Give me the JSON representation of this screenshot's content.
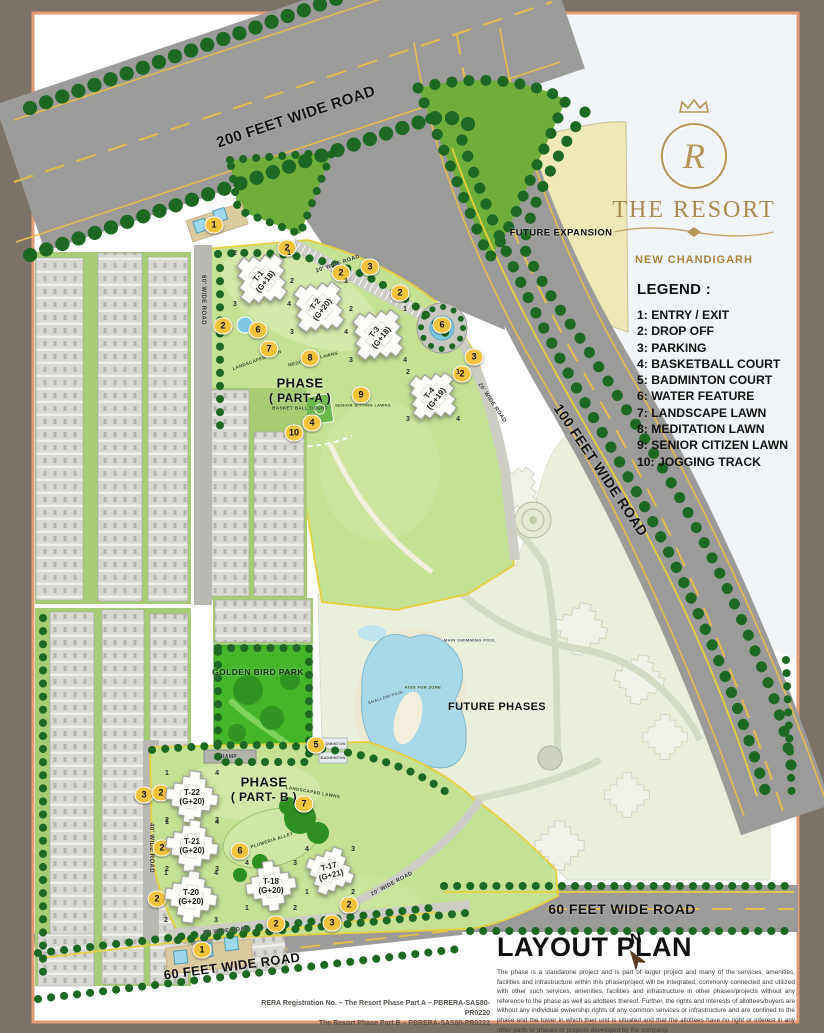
{
  "brand": {
    "monogram": "R",
    "name": "THE RESORT",
    "city": "NEW CHANDIGARH"
  },
  "legend": {
    "title": "LEGEND :",
    "items": [
      "1: ENTRY / EXIT",
      "2: DROP OFF",
      "3: PARKING",
      "4: BASKETBALL COURT",
      "5: BADMINTON COURT",
      "6: WATER FEATURE",
      "7: LANDSCAPE LAWN",
      "8: MEDITATION LAWN",
      "9: SENIOR CITIZEN LAWN",
      "10: JOGGING TRACK"
    ]
  },
  "layout_plan": {
    "title": "LAYOUT PLAN",
    "north_label": "N",
    "disclaimer": "The phase is a standalone project and is part of larger project and many of the services, amenities, facilities and infrastructure within this phase/project will be integrated, commonly connected and utilized with other such services, amenities, facilities and infrastructure in other phases/projects without any reference to the phase as well as allottees thereof. Further, the rights and interests of allottees/buyers are without any individual ownership rights of any common services or infrastructure and are confined to the phase and the tower in which their unit is situated and that the allottees have no right or interest in any other parts or phases or projects developed by the company.",
    "rera_line1": "RERA Registration No. – The Resort Phase Part A – PBRERA-SAS80-PR0220",
    "rera_line2": "The Resort Phase Part B – PBRERA-SAS80-PR0222"
  },
  "map_labels": [
    {
      "text": "200 FEET WIDE ROAD",
      "x": 296,
      "y": 117,
      "rot": -18.5,
      "fs": 15
    },
    {
      "text": "100 FEET WIDE ROAD",
      "x": 601,
      "y": 470,
      "rot": 56,
      "fs": 14
    },
    {
      "text": "60 FEET WIDE ROAD",
      "x": 622,
      "y": 909,
      "rot": 0,
      "fs": 14
    },
    {
      "text": "60 FEET WIDE ROAD",
      "x": 232,
      "y": 966,
      "rot": -7.5,
      "fs": 13
    },
    {
      "text": "FUTURE EXPANSION",
      "x": 561,
      "y": 233,
      "fs": 9.5
    },
    {
      "text": "PHASE",
      "x": 300,
      "y": 383,
      "fs": 13
    },
    {
      "text": "( PART-A )",
      "x": 300,
      "y": 398,
      "fs": 12
    },
    {
      "text": "PHASE",
      "x": 264,
      "y": 782,
      "fs": 13
    },
    {
      "text": "( PART- B )",
      "x": 264,
      "y": 797,
      "fs": 12
    },
    {
      "text": "GOLDEN BIRD PARK",
      "x": 258,
      "y": 672,
      "fs": 8.5,
      "color": "#12300a"
    },
    {
      "text": "FUTURE PHASES",
      "x": 497,
      "y": 707,
      "fs": 11
    },
    {
      "text": "20' WIDE ROAD",
      "x": 338,
      "y": 264,
      "rot": -19,
      "fs": 5.5,
      "color": "#333"
    },
    {
      "text": "20' WIDE ROAD",
      "x": 492,
      "y": 403,
      "rot": 56,
      "fs": 5.5,
      "color": "#333"
    },
    {
      "text": "20' WIDE ROAD",
      "x": 226,
      "y": 931,
      "rot": -6,
      "fs": 5.5,
      "color": "#333"
    },
    {
      "text": "20' WIDE ROAD",
      "x": 392,
      "y": 884,
      "rot": -28,
      "fs": 5.5,
      "color": "#333"
    },
    {
      "text": "60' WIDE ROAD",
      "x": 203,
      "y": 300,
      "rot": 90,
      "fs": 6,
      "color": "#333"
    },
    {
      "text": "40' WIDE ROAD",
      "x": 151,
      "y": 848,
      "rot": 90,
      "fs": 6,
      "color": "#333"
    },
    {
      "text": "RAMP",
      "x": 229,
      "y": 757,
      "fs": 5,
      "color": "#333"
    },
    {
      "text": "PLUMERIA ALLEY",
      "x": 272,
      "y": 840,
      "rot": -18,
      "fs": 4.5,
      "color": "#2c4a12"
    },
    {
      "text": "LANDSCAPED LAWNS",
      "x": 313,
      "y": 792,
      "rot": 10,
      "fs": 4.5,
      "color": "#2c4a12"
    },
    {
      "text": "MEDITATION LAWNS",
      "x": 313,
      "y": 359,
      "rot": -14,
      "fs": 4.5,
      "color": "#2c4a12"
    },
    {
      "text": "LANDSCAPED LAWN",
      "x": 257,
      "y": 360,
      "rot": -20,
      "fs": 4.5,
      "color": "#2c4a12"
    },
    {
      "text": "BASKET BALL COURT",
      "x": 300,
      "y": 408,
      "fs": 4.5,
      "color": "#17380d"
    },
    {
      "text": "SENIOR SITTING LAWNS",
      "x": 363,
      "y": 405,
      "fs": 4,
      "color": "#2c4a12"
    },
    {
      "text": "BADMINTON",
      "x": 333,
      "y": 744,
      "fs": 3.5,
      "color": "#444"
    },
    {
      "text": "BADMINTON",
      "x": 333,
      "y": 758,
      "fs": 3.5,
      "color": "#444"
    },
    {
      "text": "MAIN SWIMMING POOL",
      "x": 470,
      "y": 640,
      "fs": 4,
      "color": "#445566"
    },
    {
      "text": "SHALLOW POOL",
      "x": 386,
      "y": 697,
      "rot": -18,
      "fs": 4,
      "color": "#445566"
    },
    {
      "text": "KIDS FUN ZONE",
      "x": 423,
      "y": 687,
      "fs": 4,
      "color": "#2c4a12"
    }
  ],
  "markers": [
    {
      "n": "1",
      "x": 214,
      "y": 225
    },
    {
      "n": "2",
      "x": 287,
      "y": 248
    },
    {
      "n": "2",
      "x": 341,
      "y": 273
    },
    {
      "n": "3",
      "x": 370,
      "y": 267
    },
    {
      "n": "2",
      "x": 400,
      "y": 293
    },
    {
      "n": "2",
      "x": 223,
      "y": 326
    },
    {
      "n": "6",
      "x": 258,
      "y": 330
    },
    {
      "n": "7",
      "x": 269,
      "y": 349
    },
    {
      "n": "8",
      "x": 310,
      "y": 358
    },
    {
      "n": "6",
      "x": 442,
      "y": 325
    },
    {
      "n": "3",
      "x": 474,
      "y": 357
    },
    {
      "n": "2",
      "x": 462,
      "y": 374
    },
    {
      "n": "9",
      "x": 361,
      "y": 395
    },
    {
      "n": "4",
      "x": 312,
      "y": 423
    },
    {
      "n": "10",
      "x": 294,
      "y": 433
    },
    {
      "n": "5",
      "x": 316,
      "y": 745
    },
    {
      "n": "3",
      "x": 144,
      "y": 795
    },
    {
      "n": "2",
      "x": 161,
      "y": 793
    },
    {
      "n": "7",
      "x": 304,
      "y": 804
    },
    {
      "n": "2",
      "x": 162,
      "y": 848
    },
    {
      "n": "6",
      "x": 240,
      "y": 851
    },
    {
      "n": "2",
      "x": 157,
      "y": 899
    },
    {
      "n": "2",
      "x": 276,
      "y": 924
    },
    {
      "n": "2",
      "x": 349,
      "y": 905
    },
    {
      "n": "3",
      "x": 332,
      "y": 923
    },
    {
      "n": "1",
      "x": 202,
      "y": 950
    }
  ],
  "towers": [
    {
      "name": "T-1",
      "config": "(G+18)",
      "x": 262,
      "y": 279,
      "s": 62,
      "shapeRot": 38,
      "labelRot": -52,
      "tl": "2",
      "tr": "1",
      "bl": "3",
      "br": "4"
    },
    {
      "name": "T-2",
      "config": "(G+20)",
      "x": 319,
      "y": 307,
      "s": 62,
      "shapeRot": 38,
      "labelRot": -52,
      "tl": "2",
      "tr": "1",
      "bl": "3",
      "br": "4"
    },
    {
      "name": "T-3",
      "config": "(G+18)",
      "x": 378,
      "y": 335,
      "s": 62,
      "shapeRot": 38,
      "labelRot": -52,
      "tl": "2",
      "tr": "1",
      "bl": "3",
      "br": "4"
    },
    {
      "name": "T-4",
      "config": "(G+19)",
      "x": 433,
      "y": 396,
      "s": 58,
      "shapeRot": 38,
      "labelRot": -52,
      "tl": "2",
      "tr": "1",
      "bl": "3",
      "br": "4"
    },
    {
      "name": "T-22",
      "config": "(G+20)",
      "x": 192,
      "y": 797,
      "s": 58,
      "shapeRot": 8,
      "labelRot": 0,
      "tl": "1",
      "tr": "4",
      "bl": "2",
      "br": "3"
    },
    {
      "name": "T-21",
      "config": "(G+20)",
      "x": 192,
      "y": 846,
      "s": 58,
      "shapeRot": 8,
      "labelRot": 0,
      "tl": "1",
      "tr": "4",
      "bl": "2",
      "br": "3"
    },
    {
      "name": "T-20",
      "config": "(G+20)",
      "x": 191,
      "y": 897,
      "s": 58,
      "shapeRot": 8,
      "labelRot": 0,
      "tl": "1",
      "tr": "4",
      "bl": "2",
      "br": "3"
    },
    {
      "name": "T-18",
      "config": "(G+20)",
      "x": 271,
      "y": 886,
      "s": 56,
      "shapeRot": -8,
      "labelRot": 0,
      "tl": "4",
      "tr": "3",
      "bl": "1",
      "br": "2"
    },
    {
      "name": "T-17",
      "config": "(G+21)",
      "x": 330,
      "y": 871,
      "s": 54,
      "shapeRot": 20,
      "labelRot": -15,
      "tl": "4",
      "tr": "3",
      "bl": "1",
      "br": "2"
    }
  ]
}
